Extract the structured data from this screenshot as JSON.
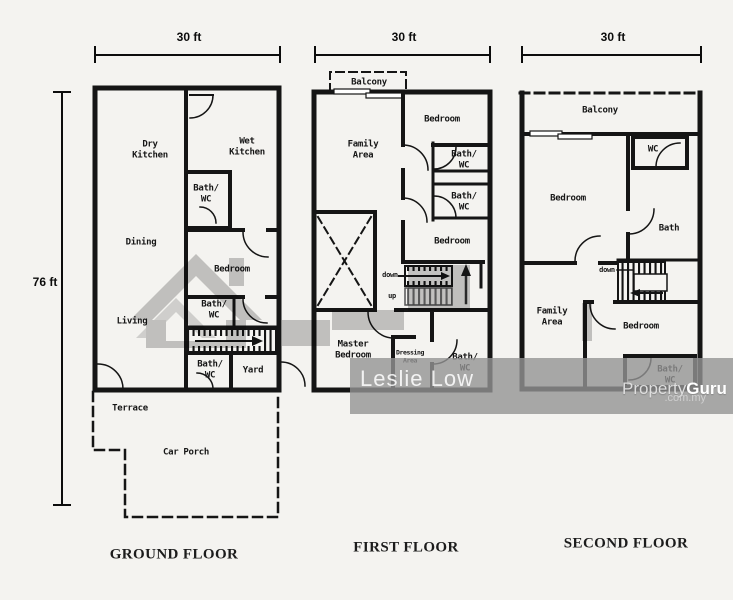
{
  "dimensions": {
    "ground_width": "30 ft",
    "first_width": "30 ft",
    "second_width": "30 ft",
    "height": "76 ft"
  },
  "floors": {
    "ground": {
      "title": "GROUND FLOOR",
      "rooms": {
        "dry_kitchen": "Dry\nKitchen",
        "wet_kitchen": "Wet\nKitchen",
        "bath_wc_top": "Bath/\nWC",
        "dining": "Dining",
        "bedroom": "Bedroom",
        "bath_wc_mid": "Bath/\nWC",
        "living": "Living",
        "bath_wc_bottom": "Bath/\nWC",
        "yard": "Yard",
        "terrace": "Terrace",
        "car_porch": "Car Porch"
      }
    },
    "first": {
      "title": "FIRST FLOOR",
      "rooms": {
        "balcony": "Balcony",
        "family_area": "Family\nArea",
        "bedroom_top": "Bedroom",
        "bath_wc_1": "Bath/\nWC",
        "bath_wc_2": "Bath/\nWC",
        "bedroom_mid": "Bedroom",
        "master_bedroom": "Master\nBedroom",
        "dressing_area": "Dressing\nArea",
        "bath_wc_3": "Bath/\nWC"
      },
      "stairs": {
        "down": "down",
        "up": "up"
      }
    },
    "second": {
      "title": "SECOND FLOOR",
      "rooms": {
        "balcony": "Balcony",
        "wc": "WC",
        "bedroom_top": "Bedroom",
        "bath": "Bath",
        "family_area": "Family\nArea",
        "bedroom_low": "Bedroom",
        "bath_wc": "Bath/\nWC"
      },
      "stairs": {
        "down": "down"
      }
    }
  },
  "watermarks": {
    "agent": "Leslie Low",
    "brand_light": "Property",
    "brand_bold": "Guru",
    "brand_domain": ".com.my"
  },
  "colors": {
    "wall": "#151515",
    "background": "#f4f3f0",
    "watermark_gray": "#c9c9c9",
    "band_gray": "#949494"
  }
}
